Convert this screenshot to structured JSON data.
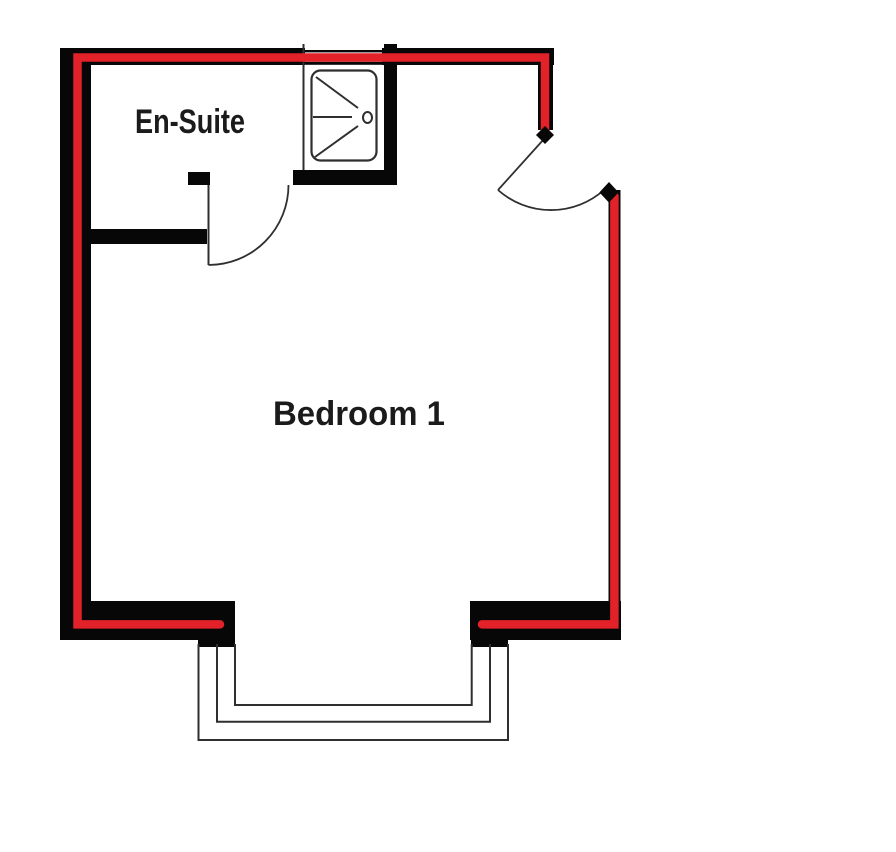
{
  "document": {
    "type": "floor-plan"
  },
  "labels": {
    "ensuite": "En-Suite",
    "bedroom": "Bedroom 1"
  },
  "colors": {
    "background": "#ffffff",
    "wall": "#070707",
    "highlight": "#e32128",
    "line": "#2f2f2f",
    "text": "#1b1b1b"
  },
  "icons": {
    "shower": "shower-tray-icon",
    "door_marker": "door-stop-diamond",
    "window": "bay-window"
  }
}
